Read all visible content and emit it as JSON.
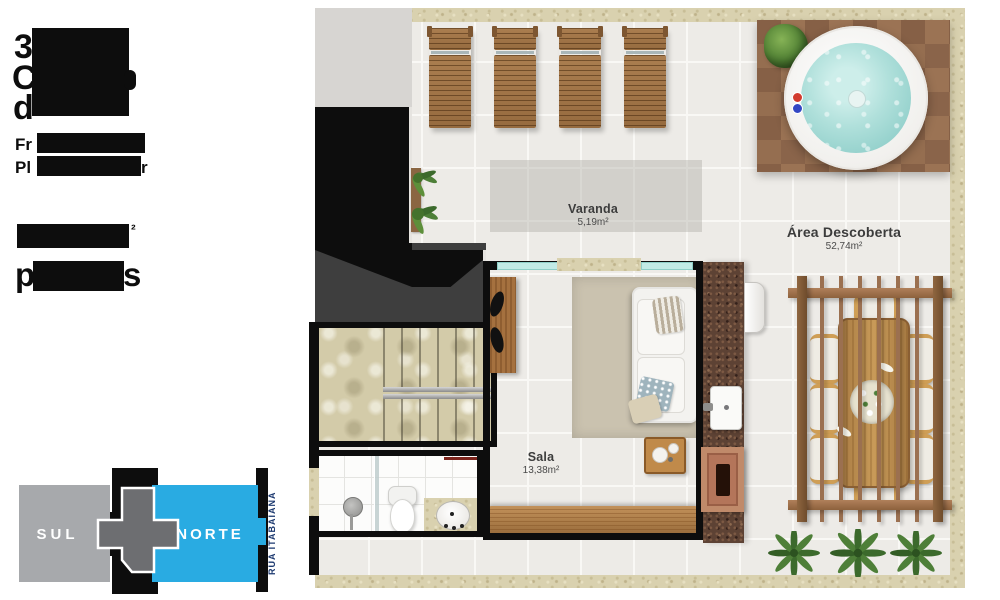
{
  "left_panel": {
    "fragments": {
      "title_line1_start": "3",
      "title_line2_start": "C",
      "title_line3_start": "d",
      "sub_line1_start": "Fr",
      "sub_line2_start": "Pl",
      "sub_line2_end": "r",
      "area_superscript": "²",
      "privative_start": "p",
      "privative_end": "s"
    }
  },
  "floor_plan": {
    "labels": {
      "varanda": {
        "name": "Varanda",
        "area": "5,19m²"
      },
      "area_descoberta": {
        "name": "Área Descoberta",
        "area": "52,74m²"
      },
      "sala": {
        "name": "Sala",
        "area": "13,38m²"
      }
    }
  },
  "compass": {
    "south_label": "SUL",
    "north_label": "NORTE",
    "street_label": "RUA ITABAIANA"
  },
  "colors": {
    "north_blue": "#29abe2",
    "south_gray": "#a7a9ac",
    "footprint_gray": "#6d6e71",
    "street_text_navy": "#1d3a70",
    "water_aqua": "#aededa",
    "deck_wood": "#97704f",
    "granite_brown": "#5d4234",
    "black_roof": "#0d0d0d"
  }
}
